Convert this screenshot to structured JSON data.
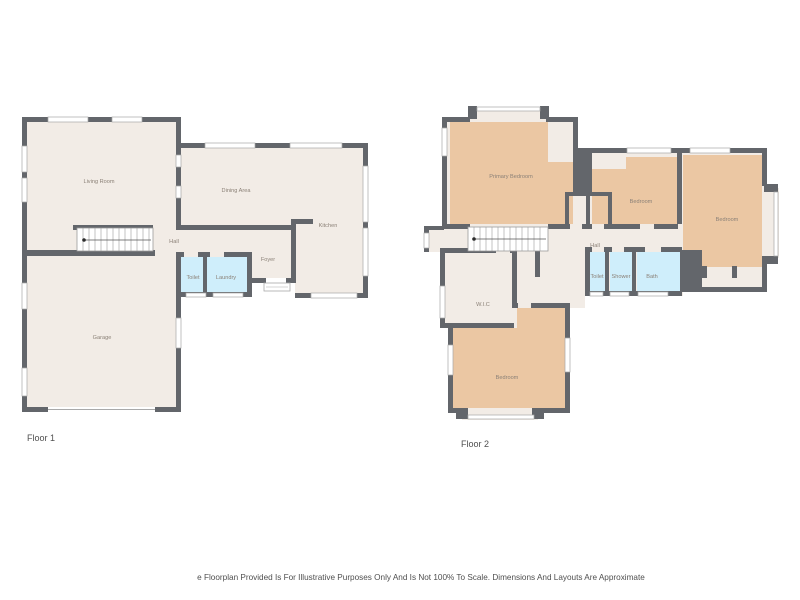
{
  "page": {
    "disclaimer": "e Floorplan Provided Is For Illustrative Purposes Only And Is Not 100% To Scale. Dimensions And Layouts Are Approximate"
  },
  "palette": {
    "wall": "#63666b",
    "floor": "#f2ece6",
    "bedroom_fill": "#ebc7a3",
    "wet_room_fill": "#cfeefb",
    "window_line": "#a9a9a9",
    "room_label": "#8b8177",
    "title_text": "#4f4f4f"
  },
  "floor1": {
    "title": "Floor 1",
    "rooms": {
      "living": "Living Room",
      "dining": "Dining Area",
      "kitchen": "Kitchen",
      "hall": "Hall",
      "foyer": "Foyer",
      "toilet": "Toilet",
      "laundry": "Laundry",
      "garage": "Garage"
    }
  },
  "floor2": {
    "title": "Floor 2",
    "rooms": {
      "primary_bedroom": "Primary Bedroom",
      "bedroom_mid": "Bedroom",
      "bedroom_right": "Bedroom",
      "hall": "Hall",
      "toilet": "Toilet",
      "shower": "Shower",
      "bath": "Bath",
      "wic": "W.I.C",
      "bedroom_bottom": "Bedroom"
    }
  }
}
